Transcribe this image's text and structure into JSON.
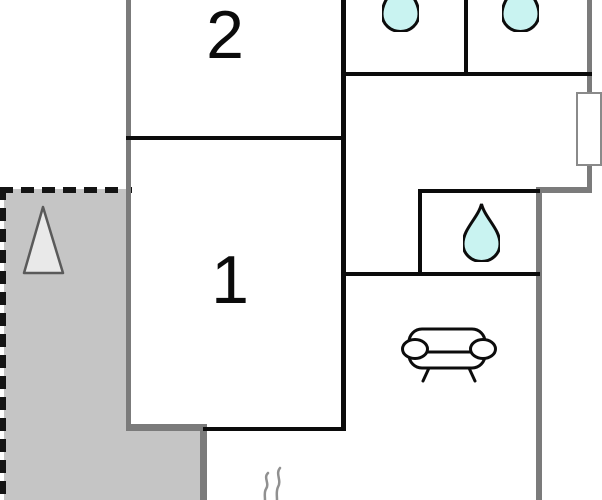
{
  "floorplan": {
    "title": "apartment-floor-plan",
    "rooms": [
      {
        "label": "2"
      },
      {
        "label": "1"
      }
    ],
    "icons": [
      "water-drop-icon (bathroom top-left)",
      "water-drop-icon (bathroom top-right)",
      "water-drop-icon (wc)",
      "sofa-icon (living room)",
      "tree-icon (terrace)",
      "steam-icon (bottom edge)",
      "window (right wall)"
    ],
    "colors": {
      "background": "#ffffff",
      "wall_black": "#0b0b0b",
      "wall_gray": "#7b7b7b",
      "terrace_fill": "#c5c5c5",
      "dashed_line": "#141414",
      "water_drop_fill": "#c9f3f1",
      "water_drop_outline": "#0c0c0c",
      "tree_fill": "#e9e9e9",
      "tree_outline": "#5a5a5a",
      "window_border": "#8a8a8a",
      "steam_gray": "#909090"
    }
  }
}
